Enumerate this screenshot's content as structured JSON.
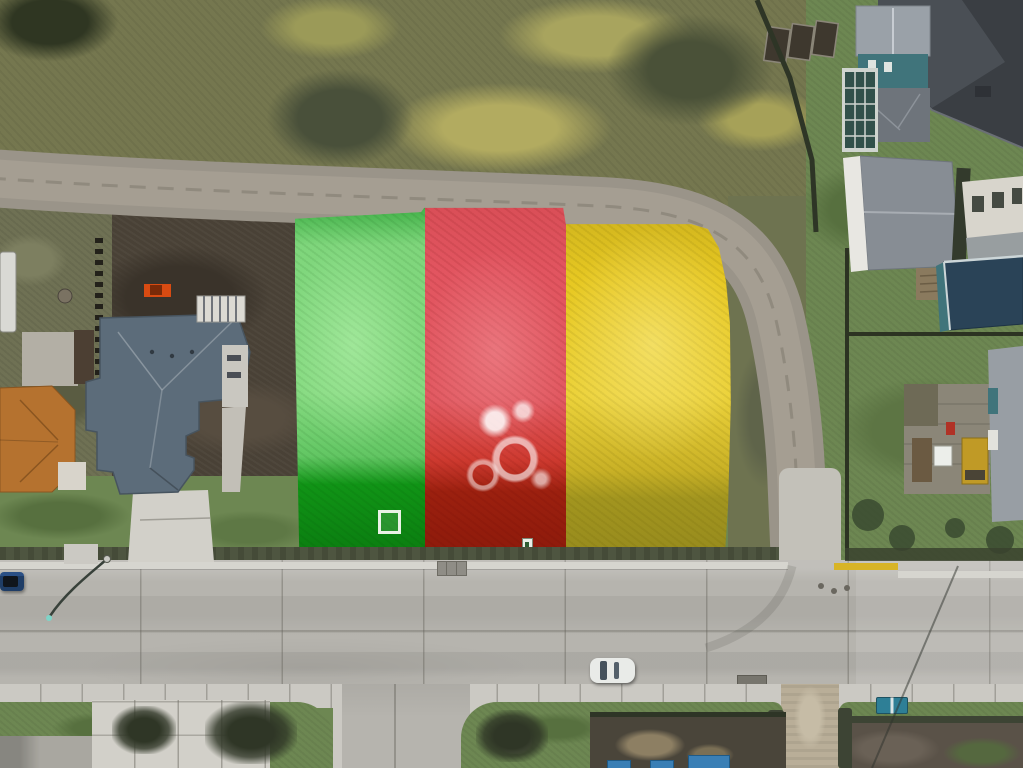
{
  "scene": {
    "type": "aerial drone photograph",
    "subject": "Vacant residential corner lot marked with three painted color zones (green, red, yellow) beside a dirt road and a paved street intersection",
    "overlay_zones": [
      {
        "id": "zone-green",
        "position": "west",
        "color": "#7fd67c"
      },
      {
        "id": "zone-red",
        "position": "center",
        "color": "#e25560"
      },
      {
        "id": "zone-yellow",
        "position": "east",
        "color": "#e7c822"
      }
    ],
    "roads": [
      {
        "id": "dirt-road",
        "surface": "gravel",
        "route": "runs west-east then curves south along the lot"
      },
      {
        "id": "paved-street",
        "surface": "concrete",
        "route": "east-west across bottom of frame"
      },
      {
        "id": "side-street",
        "surface": "concrete",
        "route": "branches south from paved street"
      },
      {
        "id": "gravel-lane",
        "surface": "gravel",
        "route": "continues south from the intersection"
      }
    ],
    "vehicles": [
      {
        "id": "blue-car",
        "color": "#1f3d66",
        "location": "parked at west curb"
      },
      {
        "id": "white-car",
        "color": "#e9ebe8",
        "location": "on paved street"
      },
      {
        "id": "orange-excavator",
        "color": "#d84b12",
        "location": "dirt yard west of lot"
      }
    ],
    "buildings": [
      {
        "id": "blue-gray-roof-house",
        "roof": "#5c6c7a",
        "location": "west of lot"
      },
      {
        "id": "orange-tile-roof-house",
        "roof": "#b5722f",
        "location": "southwest corner"
      },
      {
        "id": "charcoal-roof-house",
        "roof": "#3a3e43",
        "location": "northeast corner"
      },
      {
        "id": "teal-house-greenhouse",
        "wall": "#40747b",
        "location": "north-east with glass sunroom"
      },
      {
        "id": "gray-roof-house",
        "roof": "#878d94",
        "location": "east side"
      },
      {
        "id": "cream-house",
        "wall": "#d8d5cc",
        "location": "east edge"
      },
      {
        "id": "navy-roof-teal-house",
        "roof": "#2a4357",
        "location": "east side with wood deck"
      }
    ],
    "street_furniture": [
      {
        "id": "street-lamp",
        "note": "curved-arm lamp with shadow on road"
      },
      {
        "id": "storm-drain",
        "count": 2
      },
      {
        "id": "recycling-bins",
        "color": "#2e7f96"
      },
      {
        "id": "yellow-curb-marking",
        "color": "#d8b426"
      },
      {
        "id": "garden-beds",
        "count": 3
      }
    ],
    "lot_objects": [
      {
        "id": "white-frame-marker",
        "zone": "green"
      },
      {
        "id": "small-white-marker",
        "zone": "red"
      },
      {
        "id": "white-paint-marks",
        "zone": "red"
      }
    ]
  },
  "colors": {
    "field_base": "#75774f",
    "field_dark": "#3c432c",
    "field_darker": "#2f3622",
    "field_yellow": "#b2ab60",
    "field_light": "#8b8d66",
    "lawn": "#6d8752",
    "lawn_dark": "#57703f",
    "soil_dark": "#494136",
    "soil_darker": "#3a332a",
    "left_yard": "#6f7154",
    "dirt_road": "#9a9489",
    "dirt_road_center": "#a59e92",
    "dirt_track": "#8a8377",
    "gravel_concrete": "#c3c1b9",
    "lot_green": "#7fd67c",
    "lot_green_dark": "#109416",
    "lot_green_deep": "#0b7d10",
    "lot_red": "#e25560",
    "lot_red_dark": "#9c200f",
    "lot_yellow": "#e7c822",
    "lot_yellow_dark": "#a2951f",
    "grass_strip": "#6e7350",
    "dark_grass": "#4e5540",
    "road": "#b6b4ae",
    "curb": "#d6d5cf",
    "sidewalk": "#cbc9c3",
    "curb_yellow": "#d8b426",
    "driveway": "#d2d0c9",
    "walkway": "#c2bfb7",
    "roof_bluegray": "#5c6c7a",
    "roof_charcoal": "#3a3e43",
    "roof_charcoal_hi": "#4a4f55",
    "roof_gray": "#878d94",
    "roof_gray_light": "#9aa1a8",
    "roof_navy": "#2a4357",
    "roof_orange": "#b5722f",
    "roof_orange_dark": "#8a5520",
    "wall_teal": "#40747b",
    "wall_white": "#e8e7e2",
    "wall_cream": "#d8d5cc",
    "greenhouse_glass": "#31504a",
    "fence_dark": "#2e3526",
    "hedge_dark": "#3d4434",
    "deck_wood": "#8a7a5e",
    "patio_gray": "#8b8678",
    "machine_yellow": "#c09a26",
    "excavator_orange": "#d84b12",
    "car_blue": "#1f3d66",
    "car_white": "#e9ebe8",
    "car_window": "#46525c",
    "bins_teal": "#2e7f96",
    "trailer_white": "#d9d9d4",
    "pad_light": "#b3afa5",
    "shed_brown": "#4c3f33",
    "mulch": "#4a453a",
    "soil_garden": "#5a5248",
    "straw": "#8d7f63",
    "blue_tarp": "#3a7fb5",
    "drain_gray": "#8f8d86",
    "shadow_line": "#38413a",
    "lamp_teal": "#7fd4c8"
  }
}
